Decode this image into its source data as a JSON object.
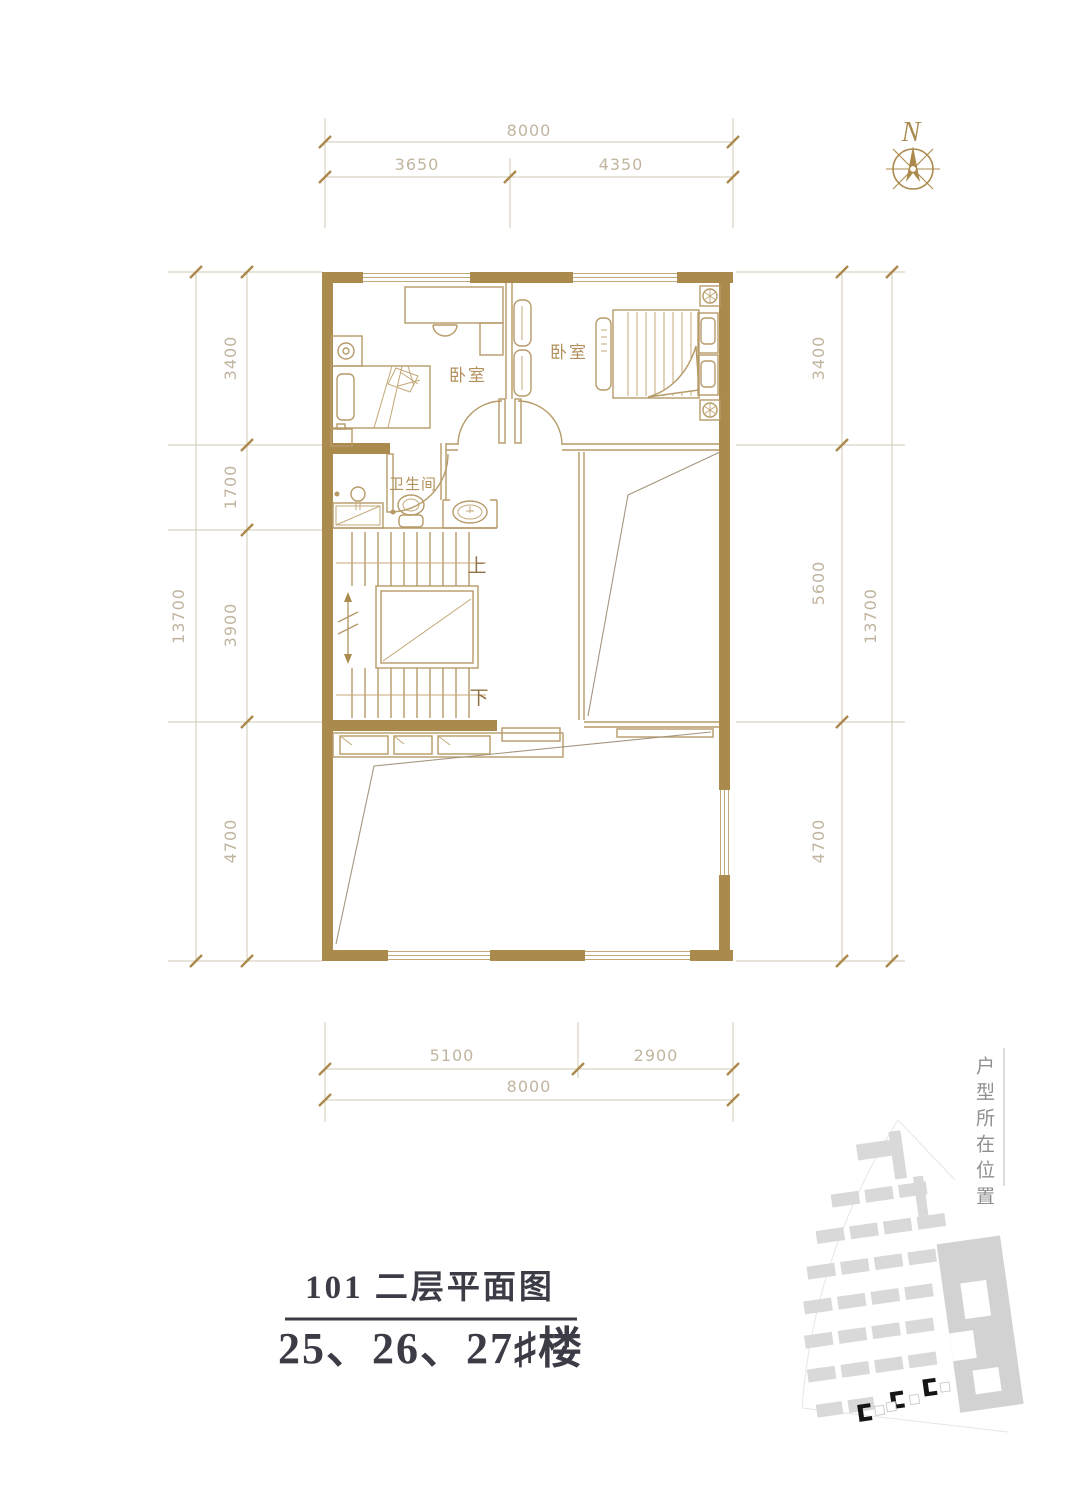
{
  "compass": {
    "label": "N"
  },
  "dimensions": {
    "top": {
      "total": "8000",
      "segments": [
        "3650",
        "4350"
      ]
    },
    "bottom": {
      "total": "8000",
      "segments": [
        "5100",
        "2900"
      ]
    },
    "left": {
      "total": "13700",
      "segments": [
        "3400",
        "1700",
        "3900",
        "4700"
      ]
    },
    "right": {
      "total": "13700",
      "segments": [
        "3400",
        "5600",
        "4700"
      ]
    }
  },
  "rooms": {
    "bedroom_left": "卧室",
    "bedroom_right": "卧室",
    "bathroom": "卫生间"
  },
  "stairs": {
    "up": "上",
    "down": "下"
  },
  "title": {
    "plan": "101 二层平面图",
    "buildings": "25、26、27♯楼"
  },
  "locator": {
    "label": "户型所在位置"
  },
  "colors": {
    "wall": "#AB8A4D",
    "furniture_line": "#B69A68",
    "dimension_text": "#C1B5A0",
    "title_text": "#3C3C46",
    "site_gray": "#D9D9D9",
    "site_highlight": "#151515"
  }
}
